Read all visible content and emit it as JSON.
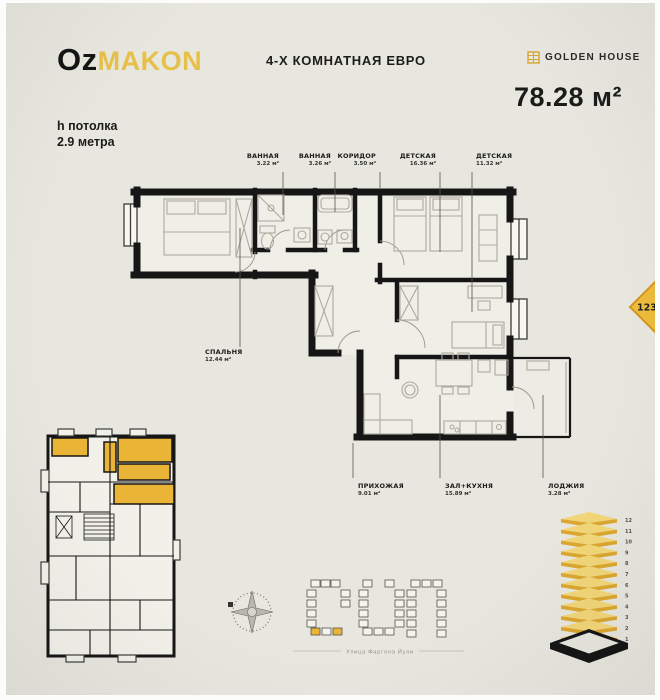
{
  "header": {
    "logo": {
      "black": "Oz",
      "gold": "MAKON"
    },
    "title": "4-Х КОМНАТНАЯ ЕВРО",
    "brand": "GOLDEN HOUSE",
    "area_value": "78.28 м²",
    "ceiling_line1": "h потолка",
    "ceiling_line2": "2.9 метра"
  },
  "plan": {
    "labels_top": [
      {
        "name": "ВАННАЯ",
        "area": "3.22 м²"
      },
      {
        "name": "ВАННАЯ",
        "area": "3.26 м²"
      },
      {
        "name": "КОРИДОР",
        "area": "3.50 м²"
      },
      {
        "name": "ДЕТСКАЯ",
        "area": "16.36 м²"
      },
      {
        "name": "ДЕТСКАЯ",
        "area": "11.32 м²"
      }
    ],
    "labels_bottom": [
      {
        "name": "ПРИХОЖАЯ",
        "area": "9.01 м²"
      },
      {
        "name": "ЗАЛ+КУХНЯ",
        "area": "15.89 м²"
      },
      {
        "name": "ЛОДЖИЯ",
        "area": "3.28 м²"
      }
    ],
    "label_left": {
      "name": "СПАЛЬНЯ",
      "area": "12.44 м²"
    }
  },
  "badge": {
    "number": "123"
  },
  "floors": [
    "12",
    "11",
    "10",
    "9",
    "8",
    "7",
    "6",
    "5",
    "4",
    "3",
    "2",
    "1"
  ],
  "site": {
    "street": "Улица Фаргона Йули"
  },
  "colors": {
    "gold": "#EAB437",
    "black": "#161616",
    "bg": "#E8E7DF"
  }
}
